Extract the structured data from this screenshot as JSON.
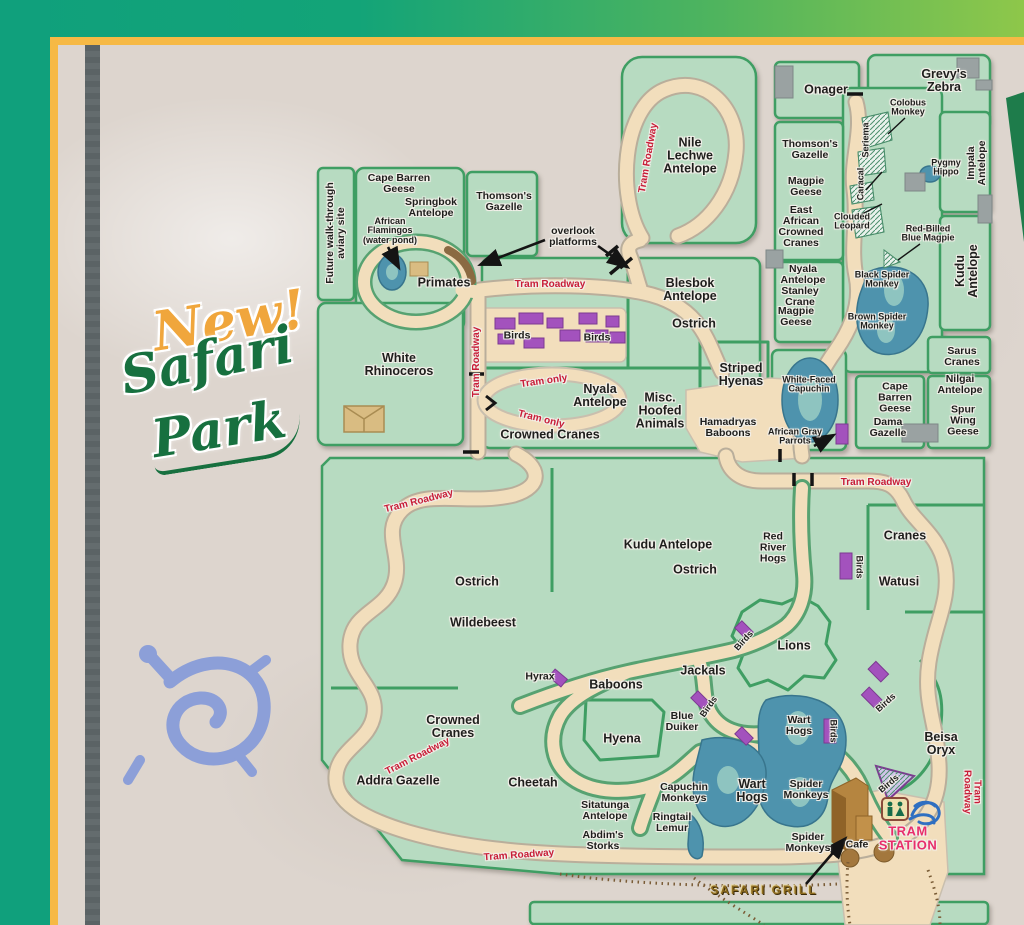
{
  "decor": {
    "new_word": "New!",
    "safari_word": "Safari",
    "park_word": "Park"
  },
  "colors": {
    "band_teal": "#10a07c",
    "band_green": "#8ec74a",
    "frame_yellow": "#f6b945",
    "stone": "#ddd5ce",
    "enclosure_green": "#b7dbc1",
    "border_green": "#3f9e63",
    "path_tan": "#f2debc",
    "tram_label_red": "#c81d38",
    "birds_purple": "#a352bd",
    "pond_blue": "#4e93ad",
    "station_pink": "#e82e6b",
    "petroglyph_blue": "#8c9fd8"
  },
  "map": {
    "labels": [
      {
        "t": "Future walk-through\naviary site",
        "x": 336,
        "y": 233,
        "r": -90,
        "c": "b"
      },
      {
        "t": "Cape Barren\nGeese",
        "x": 399,
        "y": 184,
        "r": 0,
        "c": "b"
      },
      {
        "t": "Springbok\nAntelope",
        "x": 431,
        "y": 208,
        "r": 0,
        "c": "b"
      },
      {
        "t": "African\nFlamingos\n(water pond)",
        "x": 390,
        "y": 231,
        "r": 0,
        "c": "bs"
      },
      {
        "t": "Thomson's\nGazelle",
        "x": 504,
        "y": 202,
        "r": 0,
        "c": "b"
      },
      {
        "t": "overlook\nplatforms",
        "x": 573,
        "y": 237,
        "r": 0,
        "c": "b"
      },
      {
        "t": "Primates",
        "x": 444,
        "y": 283,
        "r": 0,
        "c": "bl"
      },
      {
        "t": "White\nRhinoceros",
        "x": 399,
        "y": 365,
        "r": 0,
        "c": "bl"
      },
      {
        "t": "Nile\nLechwe\nAntelope",
        "x": 690,
        "y": 156,
        "r": 0,
        "c": "bl"
      },
      {
        "t": "Tram Roadway",
        "x": 649,
        "y": 158,
        "r": -80,
        "c": "red"
      },
      {
        "t": "Onager",
        "x": 826,
        "y": 90,
        "r": 0,
        "c": "bl"
      },
      {
        "t": "Grevy's\nZebra",
        "x": 944,
        "y": 81,
        "r": 0,
        "c": "bl"
      },
      {
        "t": "Colobus\nMonkey",
        "x": 908,
        "y": 108,
        "r": 0,
        "c": "bs"
      },
      {
        "t": "Thomson's\nGazelle",
        "x": 810,
        "y": 150,
        "r": 0,
        "c": "b"
      },
      {
        "t": "Magpie\nGeese",
        "x": 806,
        "y": 187,
        "r": 0,
        "c": "b"
      },
      {
        "t": "East\nAfrican\nCrowned\nCranes",
        "x": 801,
        "y": 227,
        "r": 0,
        "c": "b"
      },
      {
        "t": "Seriema",
        "x": 866,
        "y": 140,
        "r": -90,
        "c": "bs"
      },
      {
        "t": "Caracal",
        "x": 861,
        "y": 184,
        "r": -90,
        "c": "bs"
      },
      {
        "t": "Clouded\nLeopard",
        "x": 852,
        "y": 222,
        "r": 0,
        "c": "bs"
      },
      {
        "t": "Pygmy\nHippo",
        "x": 946,
        "y": 168,
        "r": 0,
        "c": "bs"
      },
      {
        "t": "Impala\nAntelope",
        "x": 977,
        "y": 163,
        "r": -90,
        "c": "b"
      },
      {
        "t": "Red-Billed\nBlue Magpie",
        "x": 928,
        "y": 234,
        "r": 0,
        "c": "bs"
      },
      {
        "t": "Black Spider\nMonkey",
        "x": 882,
        "y": 280,
        "r": 0,
        "c": "bs"
      },
      {
        "t": "Kudu\nAntelope",
        "x": 967,
        "y": 271,
        "r": -90,
        "c": "bl"
      },
      {
        "t": "Brown Spider\nMonkey",
        "x": 877,
        "y": 322,
        "r": 0,
        "c": "bs"
      },
      {
        "t": "Nyala\nAntelope",
        "x": 803,
        "y": 275,
        "r": 0,
        "c": "b"
      },
      {
        "t": "Stanley\nCrane",
        "x": 800,
        "y": 297,
        "r": 0,
        "c": "b"
      },
      {
        "t": "Magpie\nGeese",
        "x": 796,
        "y": 317,
        "r": 0,
        "c": "b"
      },
      {
        "t": "Sarus\nCranes",
        "x": 962,
        "y": 357,
        "r": 0,
        "c": "b"
      },
      {
        "t": "Nilgai\nAntelope",
        "x": 960,
        "y": 385,
        "r": 0,
        "c": "b"
      },
      {
        "t": "Spur\nWing\nGeese",
        "x": 963,
        "y": 421,
        "r": 0,
        "c": "b"
      },
      {
        "t": "Cape\nBarren\nGeese",
        "x": 895,
        "y": 398,
        "r": 0,
        "c": "b"
      },
      {
        "t": "Dama\nGazelle",
        "x": 888,
        "y": 428,
        "r": 0,
        "c": "b"
      },
      {
        "t": "Striped\nHyenas",
        "x": 741,
        "y": 375,
        "r": 0,
        "c": "bl"
      },
      {
        "t": "White-Faced\nCapuchin",
        "x": 809,
        "y": 385,
        "r": 0,
        "c": "bs"
      },
      {
        "t": "Hamadryas\nBaboons",
        "x": 728,
        "y": 428,
        "r": 0,
        "c": "b"
      },
      {
        "t": "African Gray\nParrots",
        "x": 795,
        "y": 437,
        "r": 0,
        "c": "bs"
      },
      {
        "t": "Tram Roadway",
        "x": 550,
        "y": 285,
        "r": 0,
        "c": "red"
      },
      {
        "t": "Tram Roadway",
        "x": 477,
        "y": 362,
        "r": -90,
        "c": "red"
      },
      {
        "t": "Birds",
        "x": 517,
        "y": 336,
        "r": 0,
        "c": "b"
      },
      {
        "t": "Birds",
        "x": 597,
        "y": 338,
        "r": 0,
        "c": "b"
      },
      {
        "t": "Blesbok\nAntelope",
        "x": 690,
        "y": 290,
        "r": 0,
        "c": "bl"
      },
      {
        "t": "Ostrich",
        "x": 694,
        "y": 324,
        "r": 0,
        "c": "bl"
      },
      {
        "t": "Tram only",
        "x": 544,
        "y": 382,
        "r": -8,
        "c": "red"
      },
      {
        "t": "Tram only",
        "x": 541,
        "y": 420,
        "r": 14,
        "c": "red"
      },
      {
        "t": "Nyala\nAntelope",
        "x": 600,
        "y": 396,
        "r": 0,
        "c": "bl"
      },
      {
        "t": "Misc.\nHoofed\nAnimals",
        "x": 660,
        "y": 411,
        "r": 0,
        "c": "bl"
      },
      {
        "t": "Crowned Cranes",
        "x": 550,
        "y": 435,
        "r": 0,
        "c": "bl"
      },
      {
        "t": "Tram Roadway",
        "x": 419,
        "y": 502,
        "r": -14,
        "c": "red"
      },
      {
        "t": "Kudu Antelope",
        "x": 668,
        "y": 545,
        "r": 0,
        "c": "bl"
      },
      {
        "t": "Ostrich",
        "x": 695,
        "y": 570,
        "r": 0,
        "c": "bl"
      },
      {
        "t": "Ostrich",
        "x": 477,
        "y": 582,
        "r": 0,
        "c": "bl"
      },
      {
        "t": "Wildebeest",
        "x": 483,
        "y": 623,
        "r": 0,
        "c": "bl"
      },
      {
        "t": "Tram Roadway",
        "x": 876,
        "y": 483,
        "r": 0,
        "c": "red"
      },
      {
        "t": "Red\nRiver\nHogs",
        "x": 773,
        "y": 548,
        "r": 0,
        "c": "b"
      },
      {
        "t": "Cranes",
        "x": 905,
        "y": 536,
        "r": 0,
        "c": "bl"
      },
      {
        "t": "Birds",
        "x": 859,
        "y": 567,
        "r": 90,
        "c": "bs"
      },
      {
        "t": "Watusi",
        "x": 899,
        "y": 582,
        "r": 0,
        "c": "bl"
      },
      {
        "t": "Lions",
        "x": 794,
        "y": 646,
        "r": 0,
        "c": "bl"
      },
      {
        "t": "Birds",
        "x": 744,
        "y": 641,
        "r": -48,
        "c": "bs"
      },
      {
        "t": "Jackals",
        "x": 703,
        "y": 671,
        "r": 0,
        "c": "bl"
      },
      {
        "t": "Hyrax",
        "x": 540,
        "y": 677,
        "r": 0,
        "c": "b"
      },
      {
        "t": "Baboons",
        "x": 616,
        "y": 685,
        "r": 0,
        "c": "bl"
      },
      {
        "t": "Blue\nDuiker",
        "x": 682,
        "y": 722,
        "r": 0,
        "c": "b"
      },
      {
        "t": "Birds",
        "x": 709,
        "y": 707,
        "r": -55,
        "c": "bs"
      },
      {
        "t": "Crowned\nCranes",
        "x": 453,
        "y": 727,
        "r": 0,
        "c": "bl"
      },
      {
        "t": "Tram Roadway",
        "x": 418,
        "y": 757,
        "r": -27,
        "c": "red"
      },
      {
        "t": "Addra Gazelle",
        "x": 398,
        "y": 781,
        "r": 0,
        "c": "bl"
      },
      {
        "t": "Cheetah",
        "x": 533,
        "y": 783,
        "r": 0,
        "c": "bl"
      },
      {
        "t": "Hyena",
        "x": 622,
        "y": 739,
        "r": 0,
        "c": "bl"
      },
      {
        "t": "Wart\nHogs",
        "x": 799,
        "y": 726,
        "r": 0,
        "c": "b"
      },
      {
        "t": "Birds",
        "x": 833,
        "y": 731,
        "r": 90,
        "c": "bs"
      },
      {
        "t": "Birds",
        "x": 886,
        "y": 703,
        "r": -42,
        "c": "bs"
      },
      {
        "t": "Beisa\nOryx",
        "x": 941,
        "y": 744,
        "r": 0,
        "c": "bl"
      },
      {
        "t": "Tram Roadway",
        "x": 971,
        "y": 792,
        "r": 90,
        "c": "red"
      },
      {
        "t": "Wart\nHogs",
        "x": 752,
        "y": 791,
        "r": 0,
        "c": "bl"
      },
      {
        "t": "Spider\nMonkeys",
        "x": 806,
        "y": 790,
        "r": 0,
        "c": "b"
      },
      {
        "t": "Birds",
        "x": 889,
        "y": 784,
        "r": -40,
        "c": "bs"
      },
      {
        "t": "TRAM\nSTATION",
        "x": 908,
        "y": 838,
        "r": 0,
        "c": "pink"
      },
      {
        "t": "Spider\nMonkeys",
        "x": 808,
        "y": 843,
        "r": 0,
        "c": "b"
      },
      {
        "t": "Cafe",
        "x": 857,
        "y": 845,
        "r": 0,
        "c": "b"
      },
      {
        "t": "SAFARI GRILL",
        "x": 764,
        "y": 890,
        "r": 0,
        "c": "gold"
      },
      {
        "t": "Capuchin\nMonkeys",
        "x": 684,
        "y": 793,
        "r": 0,
        "c": "b"
      },
      {
        "t": "Sitatunga\nAntelope",
        "x": 605,
        "y": 811,
        "r": 0,
        "c": "b"
      },
      {
        "t": "Ringtail\nLemur",
        "x": 672,
        "y": 823,
        "r": 0,
        "c": "b"
      },
      {
        "t": "Abdim's\nStorks",
        "x": 603,
        "y": 841,
        "r": 0,
        "c": "b"
      },
      {
        "t": "Tram Roadway",
        "x": 519,
        "y": 856,
        "r": -4,
        "c": "red"
      }
    ]
  }
}
